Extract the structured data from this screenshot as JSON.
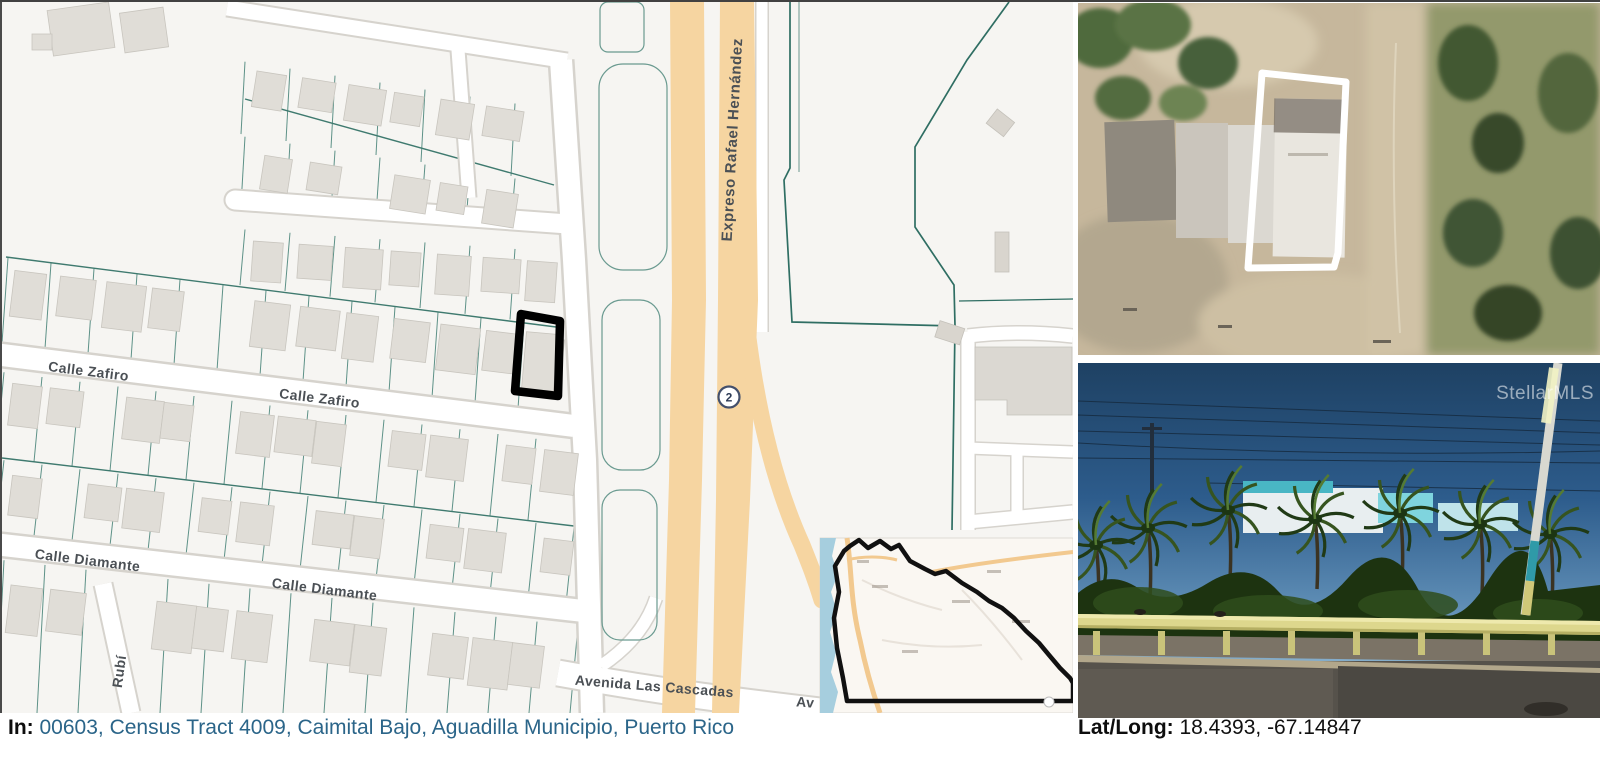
{
  "map": {
    "labels": {
      "calle_zafiro": "Calle Zafiro",
      "calle_diamante": "Calle Diamante",
      "calle_rubi": "Rubí",
      "avenida_las_cascadas": "Avenida Las Cascadas",
      "avenida_partial": "Av",
      "expreso_rafael_hernandez": "Expreso Rafael Hernández"
    },
    "route_shield": "2"
  },
  "photos": {
    "street": {
      "watermark": "StellarMLS"
    }
  },
  "captions": {
    "in_label": "In:",
    "links": [
      "00603",
      "Census Tract 4009",
      "Caimital Bajo",
      "Aguadilla Municipio",
      "Puerto Rico"
    ],
    "separator": ", ",
    "latlong_label": "Lat/Long:",
    "latlong_value": "18.4393, -67.14847"
  },
  "colors": {
    "link_blue": "#2b6589",
    "highway_orange": "#f6d5a1",
    "parcel_line_teal": "#4d877c",
    "property_outline_map": "#000000",
    "property_outline_aerial": "#ffffff",
    "guardrail_yellow": "#ddd78d",
    "inset_water_blue": "#a6cede"
  }
}
